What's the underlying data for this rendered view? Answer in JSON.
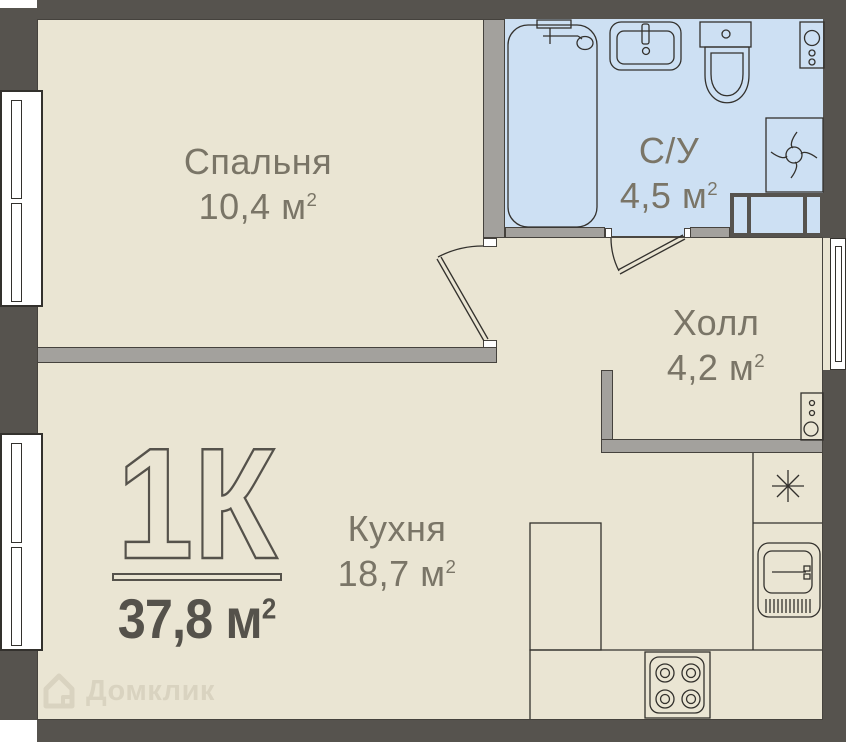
{
  "title": {
    "type_label": "1К",
    "total_area": "37,8",
    "area_unit": "м",
    "area_exponent": "2"
  },
  "rooms": [
    {
      "id": "bedroom",
      "name": "Спальня",
      "area": "10,4",
      "unit": "м",
      "exponent": "2"
    },
    {
      "id": "bathroom",
      "name": "С/У",
      "area": "4,5",
      "unit": "м",
      "exponent": "2"
    },
    {
      "id": "hall",
      "name": "Холл",
      "area": "4,2",
      "unit": "м",
      "exponent": "2"
    },
    {
      "id": "kitchen",
      "name": "Кухня",
      "area": "18,7",
      "unit": "м",
      "exponent": "2"
    }
  ],
  "watermark": {
    "brand": "Домклик"
  },
  "fixtures": {
    "bathroom": [
      "bathtub",
      "washbasin",
      "toilet",
      "pipes-riser",
      "ventilation-fan"
    ],
    "kitchen": [
      "snowflake-fridge-spot",
      "kitchen-sink",
      "stove-4-burner",
      "counter",
      "cabinet"
    ],
    "hall": [
      "electric-panel",
      "entrance-door"
    ],
    "windows": [
      "bedroom-window",
      "kitchen-window"
    ],
    "doors": [
      "bedroom-door",
      "bathroom-door"
    ]
  },
  "colors": {
    "floor": "#EAE5D3",
    "wet-floor": "#CDE0F3",
    "wall-dark": "#56534E",
    "wall-gray": "#A3A19D",
    "line": "#33312D",
    "text": "#7A7567",
    "title": "#55524B",
    "watermark": "#D9D3C0"
  }
}
